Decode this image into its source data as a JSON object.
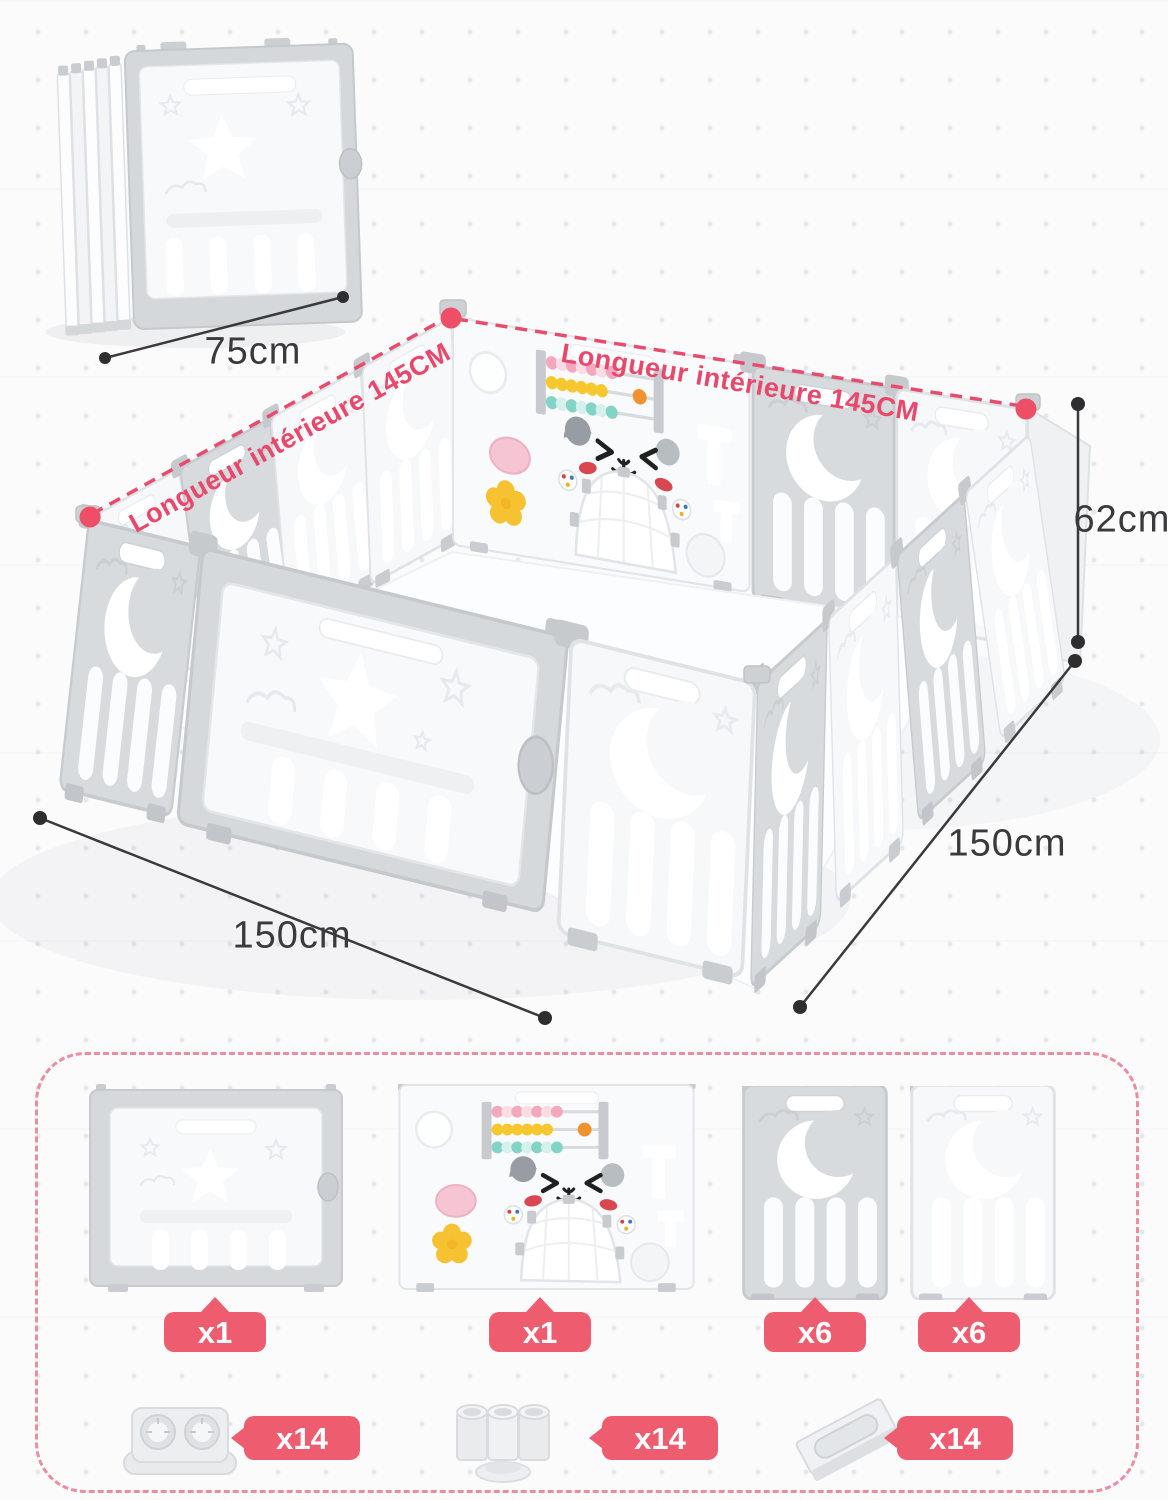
{
  "colors": {
    "badge_pink": "#ee5c70",
    "annotation_pink": "#e8486b",
    "dimension_ink": "#3a3a3c",
    "panel_white": "#f6f8f9",
    "panel_gray": "#d8dbde",
    "parts_box_border": "#eb8ca0"
  },
  "hero": {
    "folded_width_label": "75cm",
    "interior_length_left": "Longueur intérieure 145CM",
    "interior_length_right": "Longueur intérieure 145CM",
    "height_label": "62cm",
    "front_width_label": "150cm",
    "side_depth_label": "150cm"
  },
  "parts": {
    "panels": [
      {
        "name": "door-panel",
        "qty": "x1"
      },
      {
        "name": "activity-panel",
        "qty": "x1"
      },
      {
        "name": "gray-moon-panel",
        "qty": "x6"
      },
      {
        "name": "white-moon-panel",
        "qty": "x6"
      }
    ],
    "connectors": [
      {
        "name": "foot-connector",
        "qty": "x14"
      },
      {
        "name": "tube-connector",
        "qty": "x14"
      },
      {
        "name": "flat-bracket",
        "qty": "x14"
      }
    ]
  }
}
